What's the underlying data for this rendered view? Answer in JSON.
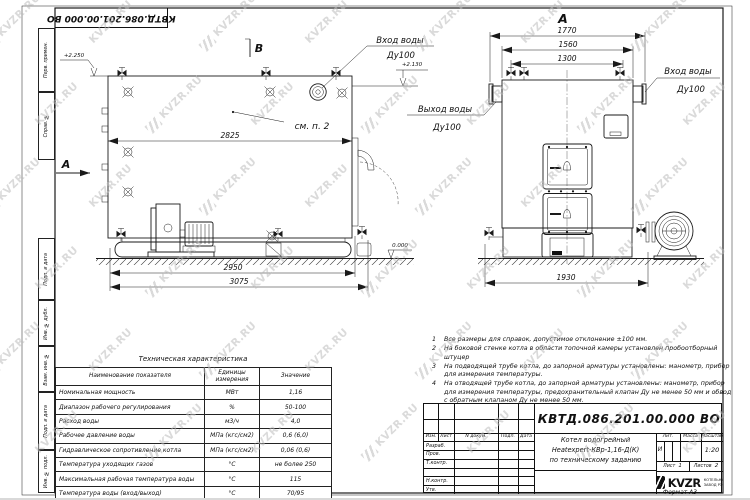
{
  "doc": {
    "number": "КВТД.086.201.00.000 ВО",
    "format": "Формат  А3"
  },
  "watermark": {
    "text": "KVZR.RU"
  },
  "margin": {
    "labels": [
      "Перв. примен.",
      "Справ. №",
      "Подп. и дата",
      "Инв. № дубл.",
      "Взам. инв. №",
      "Подп. и дата",
      "Инв. № подл."
    ]
  },
  "drawing": {
    "labels": {
      "view_a": "А",
      "view_b": "В",
      "see_item": "см. п. 2",
      "water_in": "Вход воды",
      "water_out": "Выход воды",
      "dn100": "Ду100",
      "elev_top": "+2.250",
      "elev_inlet": "+2.130",
      "elev_zero": "0.000"
    },
    "dims": {
      "side_width": "2825",
      "side_base": "2950",
      "side_total": "3075",
      "front_total": "1770",
      "front_mid": "1560",
      "front_top": "1300",
      "front_base": "1930"
    }
  },
  "table": {
    "title": "Техническая характеристика",
    "headers": {
      "name": "Наименование показателя",
      "unit": "Единицы измерения",
      "value": "Значение"
    },
    "rows": [
      {
        "name": "Номинальная мощность",
        "unit": "МВт",
        "value": "1,16"
      },
      {
        "name": "Диапазон рабочего регулирования",
        "unit": "%",
        "value": "50-100"
      },
      {
        "name": "Расход воды",
        "unit": "м3/ч",
        "value": "4,0"
      },
      {
        "name": "Рабочее давление воды",
        "unit": "МПа (кгс/см2)",
        "value": "0,6 (6,0)"
      },
      {
        "name": "Гидравлическое сопротивление котла",
        "unit": "МПа (кгс/см2)",
        "value": "0,06 (0,6)"
      },
      {
        "name": "Температура уходящих газов",
        "unit": "°С",
        "value": "не более 250"
      },
      {
        "name": "Максимальная рабочая температура воды",
        "unit": "°С",
        "value": "115"
      },
      {
        "name": "Температура воды (вход/выход)",
        "unit": "°С",
        "value": "70/95"
      },
      {
        "name": "Габариты котла (длинна х ширина х высота)",
        "unit": "мм",
        "value": "3075х1930х2250"
      }
    ]
  },
  "notes": {
    "items": [
      {
        "num": "1",
        "text": "Все размеры для справок, допустимое отклонение ±100 мм."
      },
      {
        "num": "2",
        "text": "На боковой стенке котла в области топочной камеры установлен пробоотборный штуцер"
      },
      {
        "num": "3",
        "text": "На подводящей трубе котла, до запорной арматуры установлены: манометр, прибор для измерения температуры."
      },
      {
        "num": "4",
        "text": "На отводящей трубе котла, до запорной арматуры установлены: манометр, прибор для измерения температуры, предохранительный клапан Ду не менее 50 мм и обвод с обратным клапаном Ду не менее 50 мм."
      }
    ]
  },
  "title_block": {
    "doc_number": "КВТД.086.201.00.000  ВО",
    "columns": {
      "izm": "Изм.",
      "list": "Лист",
      "ndoc": "N докум.",
      "podp": "Подп.",
      "data": "Дата"
    },
    "rows": {
      "razrab": "Разраб.",
      "prov": "Пров.",
      "tkontr": "Т.контр.",
      "nkontr": "Н.контр.",
      "utv": "Утв."
    },
    "name_lines": [
      "Котел водогрейный",
      "Heatexpert-КВр-1,16-Д(К)",
      "по техническому заданию"
    ],
    "lit_label": "Лит.",
    "lit_value": "И",
    "mass_label": "Масса",
    "scale_label": "Масштаб",
    "scale_value": "1:20",
    "sheet_label": "Лист",
    "sheet_value": "1",
    "sheets_label": "Листов",
    "sheets_value": "2",
    "logo_text": "KVZR",
    "logo_sub1": "КОТЕЛЬНЫЙ",
    "logo_sub2": "ЗАВОД РЭП"
  }
}
